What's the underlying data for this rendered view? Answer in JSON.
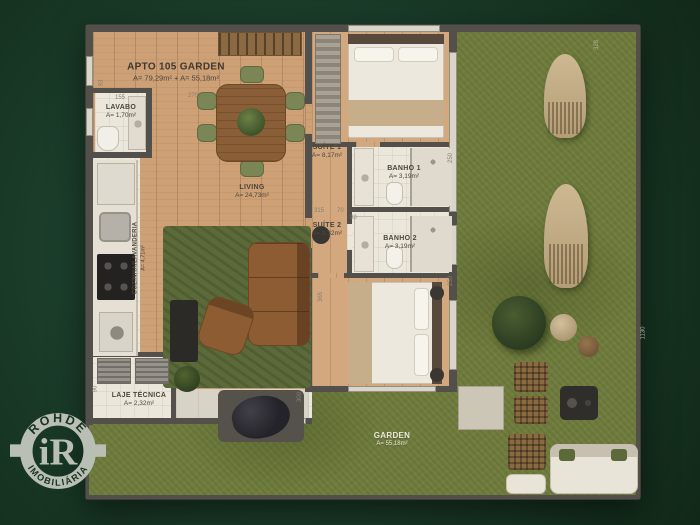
{
  "plan": {
    "title": {
      "name": "APTO 105 GARDEN",
      "area": "A= 79,29m² + A= 55,18m²"
    },
    "rooms": {
      "lavabo": {
        "name": "LAVABO",
        "area": "A= 1,70m²"
      },
      "living": {
        "name": "LIVING",
        "area": "A= 24,73m²"
      },
      "suite1": {
        "name": "SUÍTE 1",
        "area": "A= 8,17m²"
      },
      "banho1": {
        "name": "BANHO 1",
        "area": "A= 3,19m²"
      },
      "suite2": {
        "name": "SUÍTE 2",
        "area": "A= 9,32m²"
      },
      "banho2": {
        "name": "BANHO 2",
        "area": "A= 3,19m²"
      },
      "cozinha": {
        "name": "COZINHA/LAVANDERIA",
        "area": "A= 4,71m²"
      },
      "laje": {
        "name": "LAJE TÉCNICA",
        "area": "A= 2,32m²"
      },
      "garden": {
        "name": "GARDEN",
        "area": "A= 55,18m²"
      }
    },
    "dimensions": [
      "93",
      "155",
      "270",
      "328",
      "250",
      "315",
      "70",
      "90",
      "365",
      "300",
      "250",
      "1130",
      "90"
    ]
  },
  "logo": {
    "top": "ROHDE",
    "bottom": "IMOBILIÁRIA",
    "monogram": "iR"
  },
  "colors": {
    "background": "#1c3e2b",
    "grass": "#6f7c3e",
    "wood": "#cda076",
    "wall": "#53504b",
    "floor_light": "#ece7db",
    "logo_silver": "#b9bfb4",
    "label_text": "#4c463c"
  }
}
